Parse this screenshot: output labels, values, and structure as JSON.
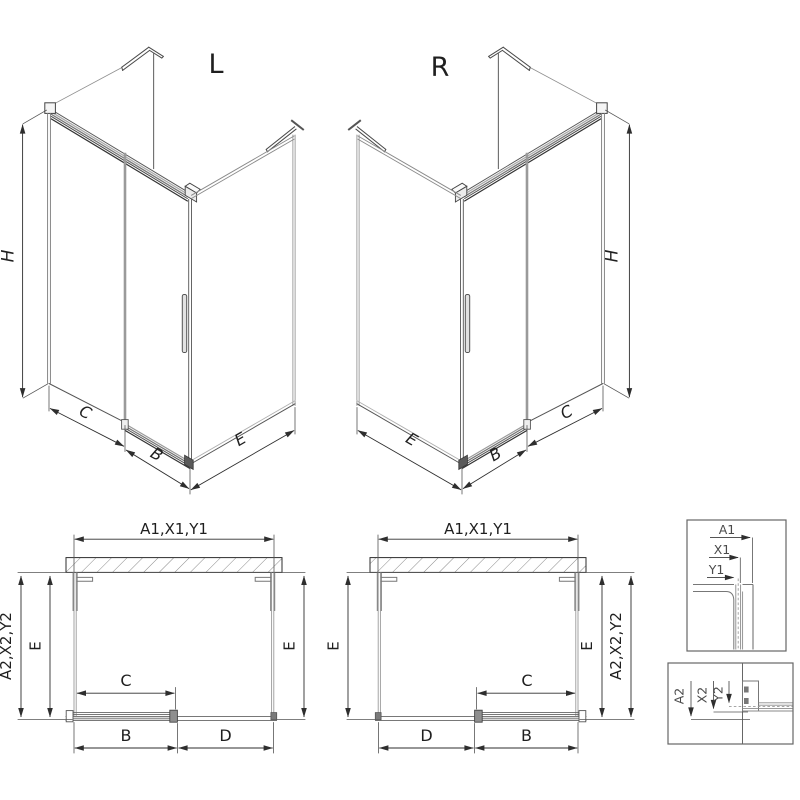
{
  "colors": {
    "background": "#ffffff",
    "line_dark": "#2e2e2e",
    "line_mid": "#555555",
    "line_gray": "#8a8a8a",
    "text": "#1f1f1f",
    "detail_text": "#4a4a4a"
  },
  "iso_left": {
    "title": "L",
    "dim_height": "H",
    "dim_c": "C",
    "dim_b": "B",
    "dim_e": "E"
  },
  "iso_right": {
    "title": "R",
    "dim_height": "H",
    "dim_c": "C",
    "dim_b": "B",
    "dim_e": "E"
  },
  "plan_left": {
    "dim_width_top": "A1,X1,Y1",
    "dim_depth_outer": "A2,X2,Y2",
    "dim_e_left": "E",
    "dim_e_right": "E",
    "dim_c": "C",
    "dim_b": "B",
    "dim_d": "D"
  },
  "plan_right": {
    "dim_width_top": "A1,X1,Y1",
    "dim_depth_outer": "A2,X2,Y2",
    "dim_e_left": "E",
    "dim_e_right": "E",
    "dim_c": "C",
    "dim_b": "B",
    "dim_d": "D"
  },
  "detail_top": {
    "dim_a1": "A1",
    "dim_x1": "X1",
    "dim_y1": "Y1"
  },
  "detail_bottom": {
    "dim_a2": "A2",
    "dim_x2": "X2",
    "dim_y2": "Y2"
  }
}
